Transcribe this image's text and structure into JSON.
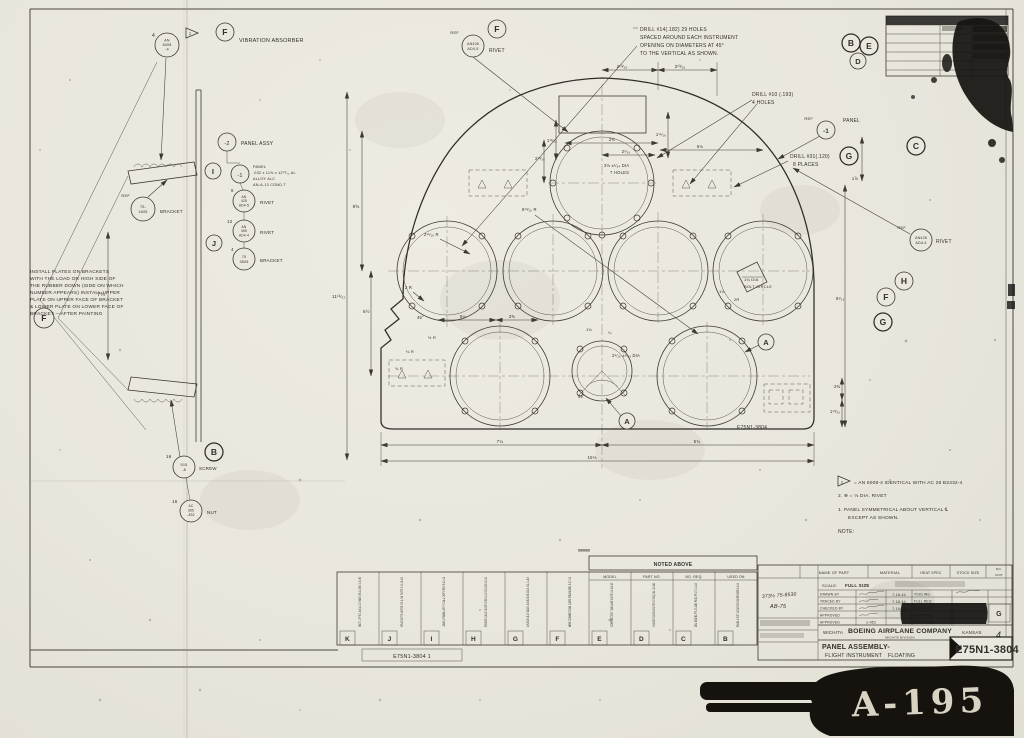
{
  "sheet": {
    "stamp": "A-195",
    "number": "E75N1-3804"
  },
  "letters": {
    "A": "A",
    "B": "B",
    "C": "C",
    "D": "D",
    "E": "E",
    "F": "F",
    "G": "G",
    "H": "H",
    "I": "I",
    "J": "J",
    "neg1": "-1",
    "neg2": "-2"
  },
  "flags": {
    "two": "2"
  },
  "qty": {
    "q4": "4",
    "q6": "6",
    "q12": "12",
    "q16": "16"
  },
  "top_notes": {
    "drill14_1": "DRILL #14(.182) 29 HOLES",
    "drill14_2": "SPACED AROUND EACH INSTRUMENT",
    "drill14_3": "OPENING ON DIAMETERS AT 45°",
    "drill14_4": "TO THE VERTICAL AS SHOWN.",
    "drill10_1": "DRILL #10 (.193)",
    "drill10_2": "4 HOLES",
    "drill31_1": "DRILL #31(.120)",
    "drill31_2": "8 PLACES",
    "ref": "REF",
    "panel": "PANEL",
    "rivet": "RIVET"
  },
  "left_view": {
    "vibration": "VIBRATION ABSORBER",
    "an6008": [
      "AN",
      "6008",
      "-4"
    ],
    "bracket_ref": [
      "75-",
      "1605"
    ],
    "bracket": "BRACKET",
    "screw_part": [
      "515",
      "-8"
    ],
    "screw": "SCREW",
    "nut_part": [
      "AC",
      "365",
      "-832"
    ],
    "nut": "NUT",
    "dim_7_34": "7¾",
    "install": [
      "INSTALL  PLATES   ON BRACKETS",
      "WITH THE LOAD OR HIGH SIDE OF",
      "THE RUBBER DOWN (SIDE ON WHICH",
      "NUMBER APPEARS) INSTALL UPPER",
      "PLATE ON UPPER FACE OF BRACKET",
      "& LOWER PLATE ON LOWER FACE OF",
      "BRACKET —AFTER PAINTING"
    ]
  },
  "parts": {
    "panel_assy": "PANEL ASSY",
    "spec": [
      "PANEL",
      ".032 x 11⅝ x 12¹³⁄₁₆ AL",
      "ALLOY ALC",
      "AN-A-13 COND.T"
    ],
    "an425": [
      "AN",
      "425",
      "AD4-5"
    ],
    "an455": [
      "AN",
      "455",
      "AD4-4"
    ],
    "b3805": [
      "75",
      "3805"
    ],
    "an426a": [
      "AN426",
      "AD4-5"
    ],
    "an426b": [
      "AN426",
      "AD4-4"
    ],
    "rivet": "RIVET",
    "bracket": "BRACKET"
  },
  "panel": {
    "hole_note": [
      "3⅛ ±¹⁄₆₄ DIA",
      "7 HOLES"
    ],
    "bolt_circle": [
      "1¾ DIA",
      "BOLT CIRCLE"
    ],
    "small_dia": "2⁹⁄₁₆ ±¹⁄₆₄ DIA",
    "number": "E75N1-3804",
    "dims": {
      "a": "2¹³⁄₁₆",
      "b": "3¹³⁄₁₆",
      "c": "2⅜",
      "d": "2¹⁄₁₆",
      "e": "1¹¹⁄₁₆",
      "f": "5⅛",
      "g": "1¹³⁄₃₂",
      "h": "2¹³⁄₁₆",
      "i": "9⅝",
      "j": "11¹³⁄₃₂",
      "k": "6½",
      "l": "7¼",
      "m": "5¾",
      "n": "15⅛",
      "o": "2¹¹⁄₁₆ R",
      "p": "8¹³⁄₁₆ R",
      "q": "2 R",
      "r": "45°",
      "s": "½ R",
      "t": "⅛ R",
      "u": "¾ R",
      "v": "5¼",
      "w": "3⅜",
      "x": "1⅛",
      "y": "¼",
      "z": "45°",
      "aa": "1⅞",
      "ab": "8¹⁄₁₆",
      "ac": "2⅜",
      "ad": "1¹³⁄₁₆",
      "ae": "2R",
      "af": "1⅛"
    }
  },
  "notes": {
    "flag_line": "= AN 6008-4 IDENTICAL WITH AC 28 B2432-4",
    "rivet_line": "2. ⊕ = ⅛ DIA. RIVET",
    "note1a": "1. PANEL SYMMETRICAL ABOUT VERTICAL ℄",
    "note1b": "EXCEPT AS SHOWN.",
    "title": "NOTE:"
  },
  "title_block": {
    "noted_above": "NOTED ABOVE",
    "cols": [
      "MODEL",
      "PART NO.",
      "NO. REQ.",
      "USED ON"
    ],
    "header": [
      "NAME OF PART",
      "MATERIAL",
      "HEAT SPEC",
      "STOCK SIZE",
      "NO.",
      "UNIT"
    ],
    "scale_lbl": "SCALE:",
    "scale_val": "FULL SIZE",
    "sig_rows": [
      "DRAWN BY",
      "TRACED BY",
      "CHECKED BY",
      "APPROVED",
      "APPROVED"
    ],
    "right_rows": [
      "TOOLING",
      "FULL REQ.",
      "APPROVED",
      "APPROVED",
      "APPROVED"
    ],
    "dates": [
      "7-18-44",
      "7-18-44",
      "7-19-44"
    ],
    "misc": "1-451",
    "hand1": "373½ 75-8530",
    "hand2": "AB-75",
    "wichita": "WICHITA",
    "company": "BOEING AIRPLANE COMPANY",
    "division": "WICHITA DIVISION",
    "kansas": "KANSAS",
    "sheet": "4",
    "title1": "PANEL ASSEMBLY-",
    "title2": "FLIGHT INSTRUMENT",
    "title3": "FLOATING",
    "dwg_no": "E75N1-3804",
    "strip_no": "E75N1-3804  1",
    "g_box": "G"
  },
  "revisions": [
    {
      "letter": "K",
      "text": "MAT'L SPEC AN-A-13 WAS 98-A-366  2-6-45"
    },
    {
      "letter": "J",
      "text": "BRACKETS WERE 53 & 54 PART 2  8-16-43"
    },
    {
      "letter": "I",
      "text": "-3800-2 PANEL ASS'Y CALL OUTS REV  9-12-43"
    },
    {
      "letter": "H",
      "text": "REMOVED CABLE HOLDER SCREW & NUT CB-2745  9-15-43"
    },
    {
      "letter": "G",
      "text": "AN515-8-8 WAS AN520-B10-8  10-1-43"
    },
    {
      "letter": "F",
      "text": "NEW CONNECTION CARD RELEASED  9-17-43"
    },
    {
      "letter": "E",
      "text": "CORRECTED TUBULAR NOTE  10-18-43"
    },
    {
      "letter": "D",
      "text": "CHANGED CONTOUR AS PER CH REQ 1561  12-14-43"
    },
    {
      "letter": "C",
      "text": "DEL MODEL PT-17 ADD PD3L PT-17  3-1-44"
    },
    {
      "letter": "B",
      "text": "PANEL & INST LOCATING DIM REVISED  6-9-44"
    }
  ]
}
